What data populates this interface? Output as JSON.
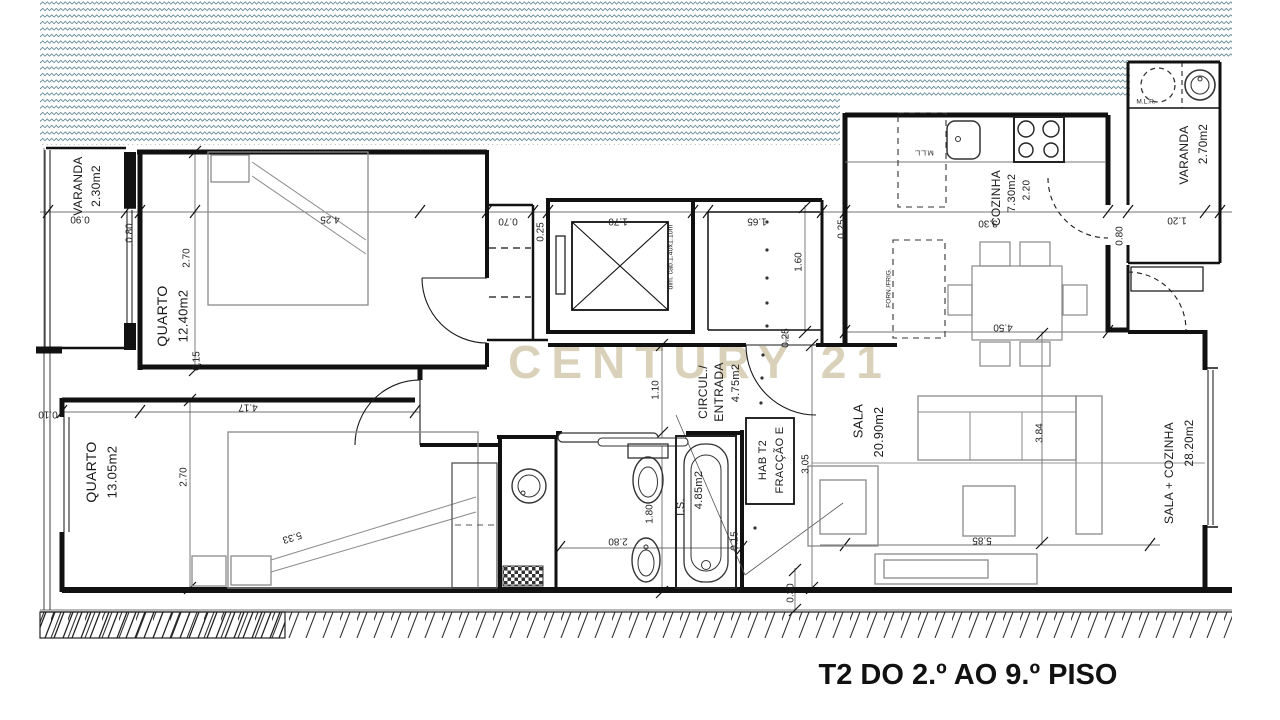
{
  "plan": {
    "title": "T2 DO 2.º AO 9.º PISO",
    "watermark": "CENTURY 21",
    "fraction_box": {
      "line1": "HAB T2",
      "line2": "FRACÇÃO E"
    },
    "rooms": {
      "varanda_left": {
        "name": "VARANDA",
        "area": "2.30m2"
      },
      "quarto_1": {
        "name": "QUARTO",
        "area": "12.40m2"
      },
      "quarto_2": {
        "name": "QUARTO",
        "area": "13.05m2"
      },
      "circulacao": {
        "name_line1": "CIRCUL./",
        "name_line2": "ENTRADA",
        "area": "4.75m2"
      },
      "instalacao_sanitaria": {
        "name": "I.S.",
        "area": "4.85m2"
      },
      "cozinha": {
        "name": "COZINHA",
        "area": "7.30m2",
        "width": "2.20"
      },
      "sala": {
        "name": "SALA",
        "area": "20.90m2"
      },
      "sala_cozinha_total": {
        "name": "SALA + COZINHA",
        "area": "28.20m2"
      },
      "varanda_right": {
        "name": "VARANDA",
        "area": "2.70m2"
      }
    },
    "annotations": {
      "elevator_cab": "dim. cab.1.40x1.10m",
      "dishwasher": "M.L.L.",
      "washing_machine": "M.L.R.",
      "oven_fridge": "FORN./FRIG."
    },
    "dims": [
      {
        "text": "0.90"
      },
      {
        "text": "0.80"
      },
      {
        "text": "4.25"
      },
      {
        "text": "2.70"
      },
      {
        "text": "0.15"
      },
      {
        "text": "0.10"
      },
      {
        "text": "4.17"
      },
      {
        "text": "2.70"
      },
      {
        "text": "5.33"
      },
      {
        "text": "0.70"
      },
      {
        "text": "0.25"
      },
      {
        "text": "1.70"
      },
      {
        "text": "1.65"
      },
      {
        "text": "0.25"
      },
      {
        "text": "1.60"
      },
      {
        "text": "0.25"
      },
      {
        "text": "1.10"
      },
      {
        "text": "1.80"
      },
      {
        "text": "2.80"
      },
      {
        "text": "0.15"
      },
      {
        "text": "3.30"
      },
      {
        "text": "4.50"
      },
      {
        "text": "3.84"
      },
      {
        "text": "5.85"
      },
      {
        "text": "3.05"
      },
      {
        "text": "0.30"
      },
      {
        "text": "1.20"
      },
      {
        "text": "0.80"
      }
    ]
  }
}
